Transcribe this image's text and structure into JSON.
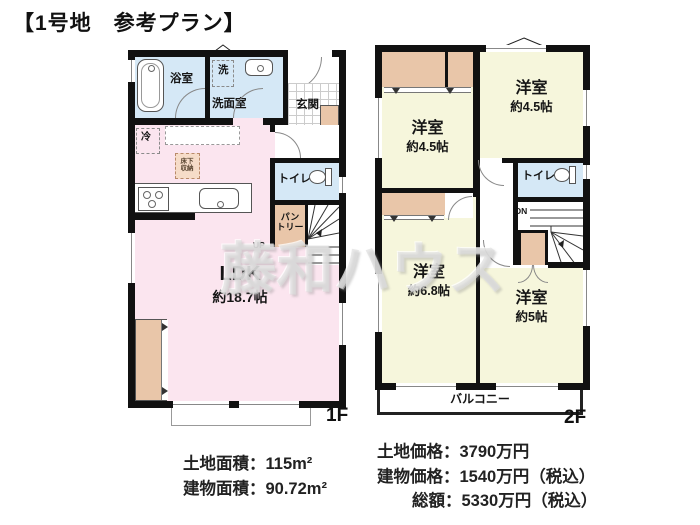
{
  "title": "【1号地　参考プラン】",
  "watermark": "藤和ハウス",
  "floor1": {
    "floor_label": "1F",
    "bath": "浴室",
    "washer": "洗",
    "washroom": "洗面室",
    "entrance": "玄関",
    "fridge": "冷",
    "underfloor_storage_line1": "床下",
    "underfloor_storage_line2": "収納",
    "toilet": "トイレ",
    "pantry_line1": "パン",
    "pantry_line2": "トリー",
    "up": "UP",
    "ldk": "LDK",
    "ldk_size": "約18.7帖"
  },
  "floor2": {
    "floor_label": "2F",
    "room_ne": "洋室",
    "room_ne_size": "約4.5帖",
    "room_nw": "洋室",
    "room_nw_size": "約4.5帖",
    "toilet": "トイレ",
    "dn": "DN",
    "room_sw": "洋室",
    "room_sw_size": "約6.8帖",
    "room_se": "洋室",
    "room_se_size": "約5帖",
    "balcony": "バルコニー"
  },
  "summary": {
    "land_area": "土地面積：115m²",
    "building_area": "建物面積：90.72m²",
    "land_price": "土地価格：3790万円",
    "building_price": "建物価格：1540万円（税込）",
    "total_price": "総額：5330万円（税込）"
  },
  "colors": {
    "wall": "#111111",
    "ldk_pink": "#fbe5ef",
    "wet_area_blue": "#d5e8f6",
    "room_yellow": "#f6f6dc",
    "closet_tan": "#e9c6a9"
  }
}
